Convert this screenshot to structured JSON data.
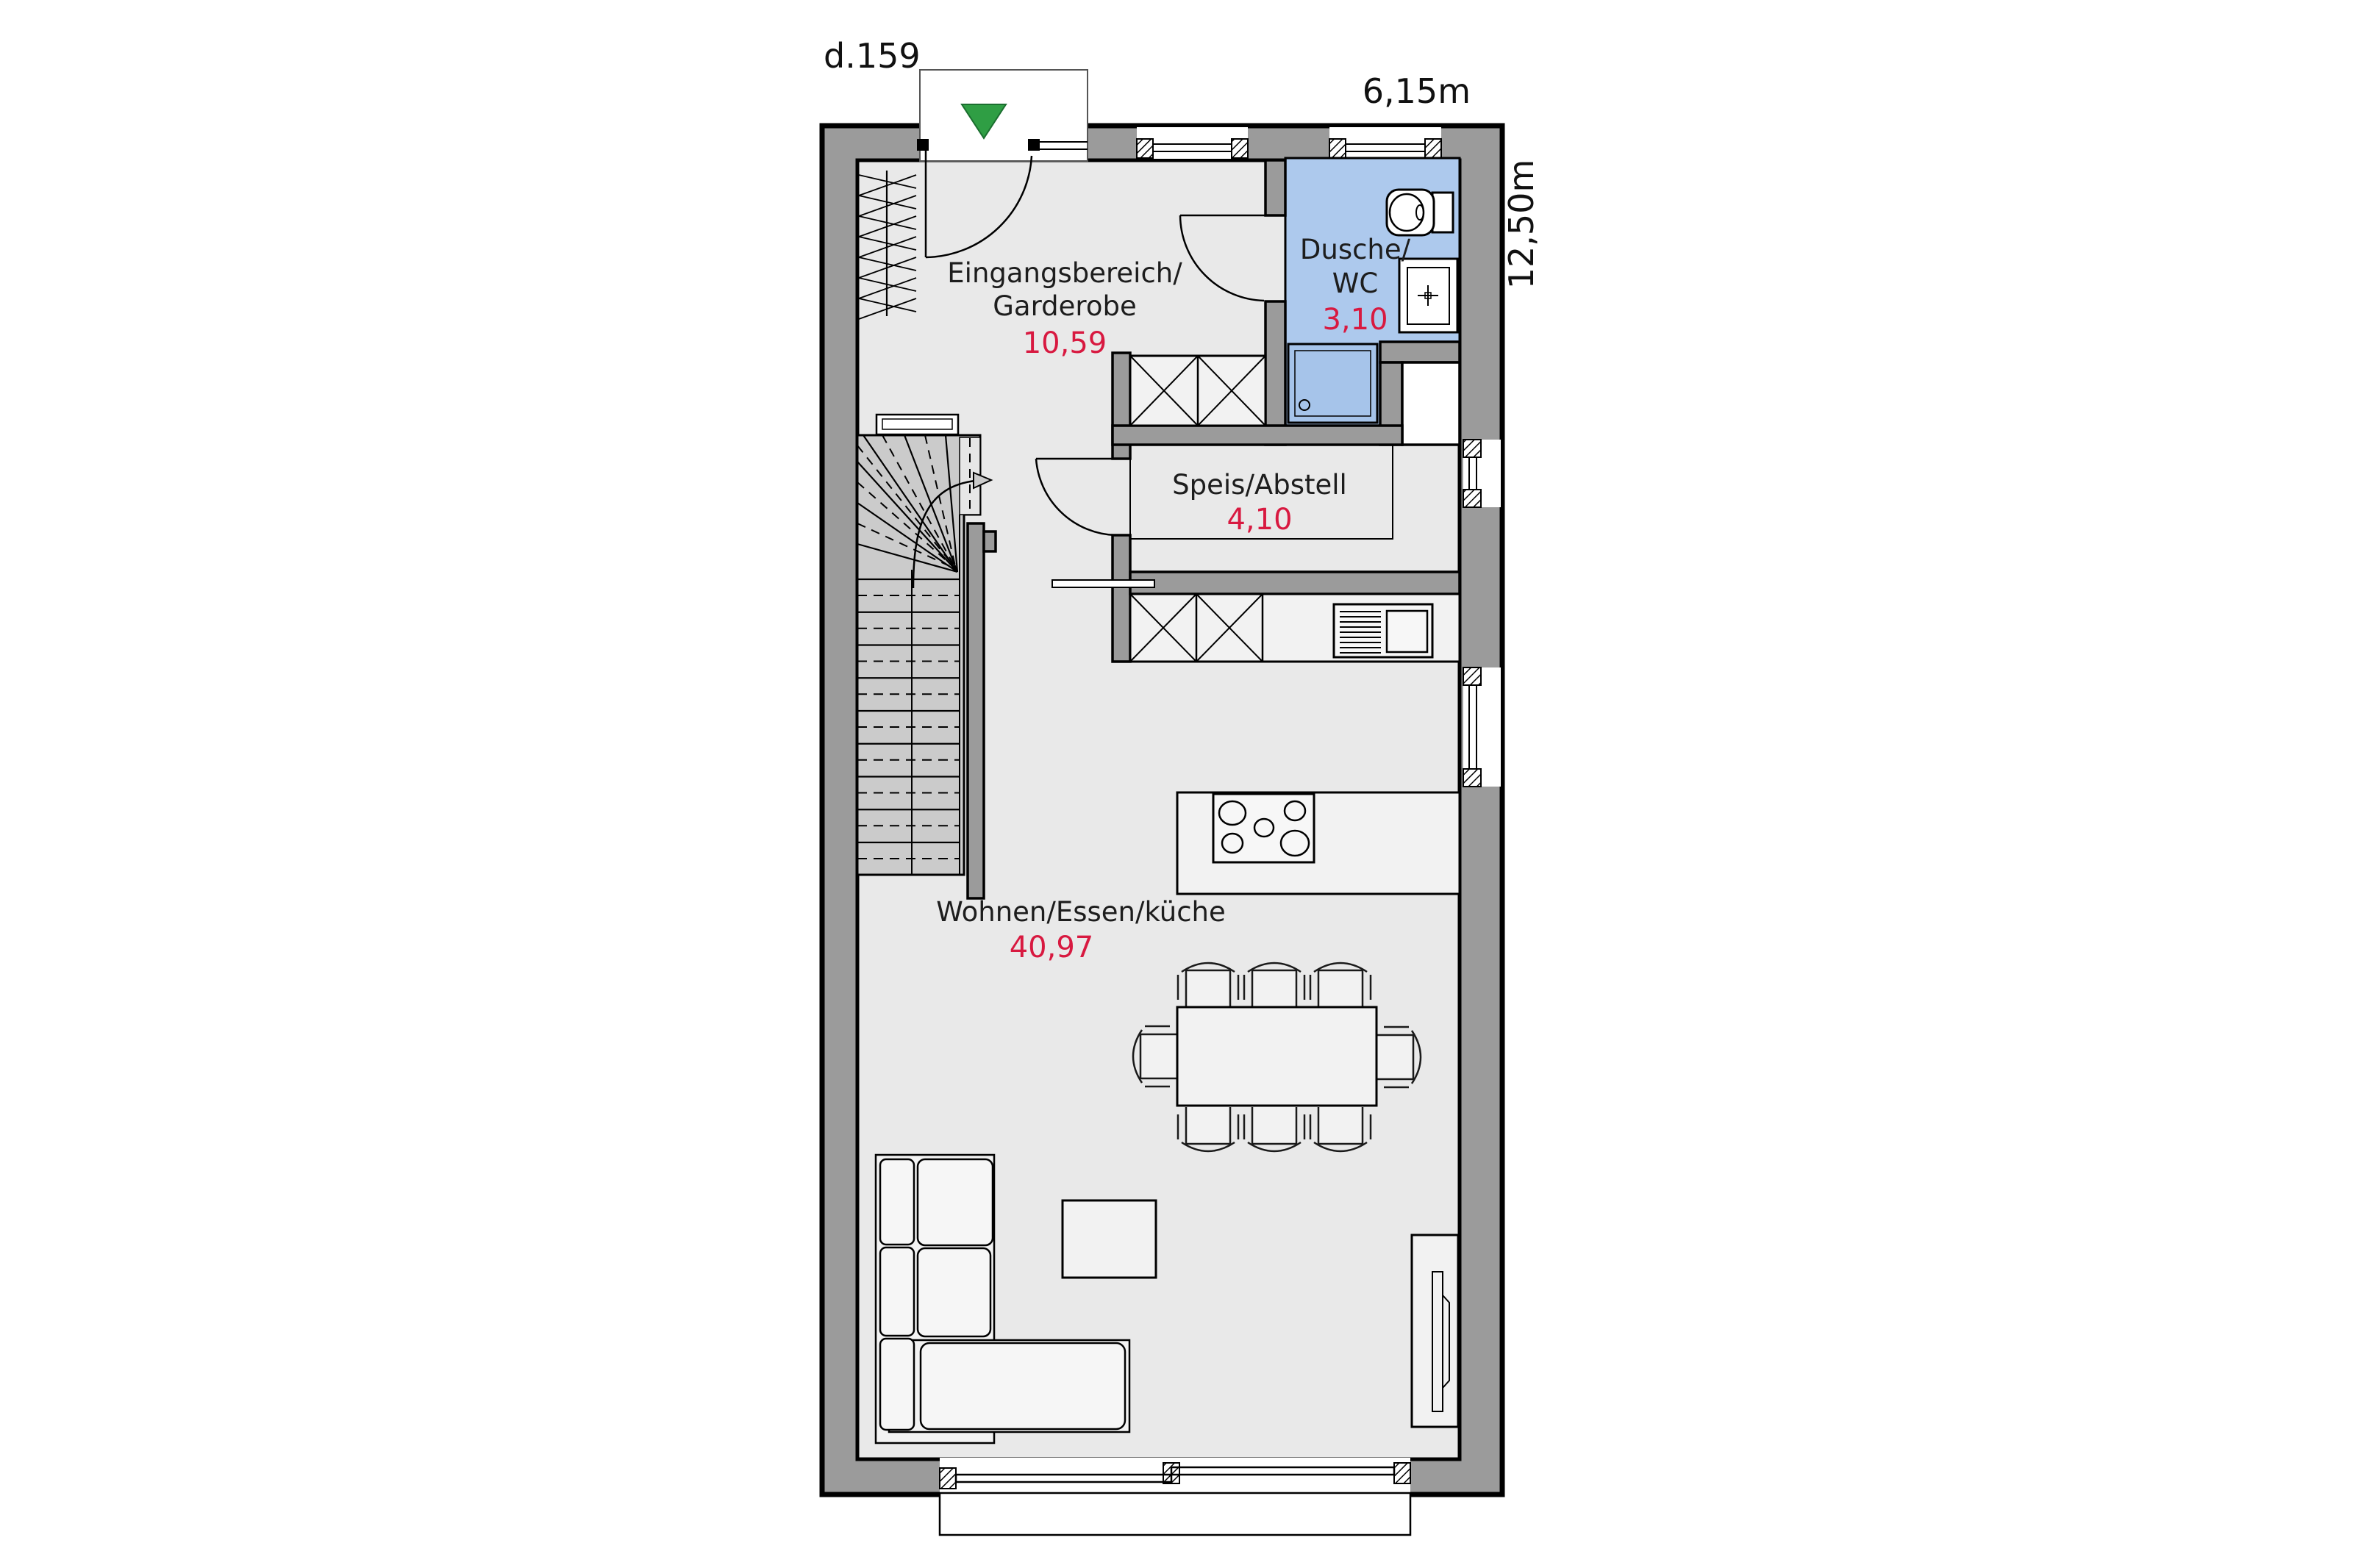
{
  "title": "d.159",
  "dimensions": {
    "width_label": "6,15m",
    "depth_label": "12,50m"
  },
  "rooms": {
    "entrance": {
      "name_line1": "Eingangsbereich/",
      "name_line2": "Garderobe",
      "area": "10,59"
    },
    "bath": {
      "name_line1": "Dusche/",
      "name_line2": "WC",
      "area": "3,10"
    },
    "storage": {
      "name": "Speis/Abstell",
      "area": "4,10"
    },
    "living": {
      "name": "Wohnen/Essen/küche",
      "area": "40,97"
    }
  },
  "icons": {
    "entrance_marker": "green-triangle-down"
  },
  "colors": {
    "accent_red": "#d81940",
    "wall_gray": "#9b9b9b",
    "floor_gray": "#e9e9e9",
    "stair_gray": "#cbcbcb",
    "bath_blue": "#adc9ed",
    "shower_blue": "#a6c4ea",
    "marker_green": "#2f9e44"
  }
}
